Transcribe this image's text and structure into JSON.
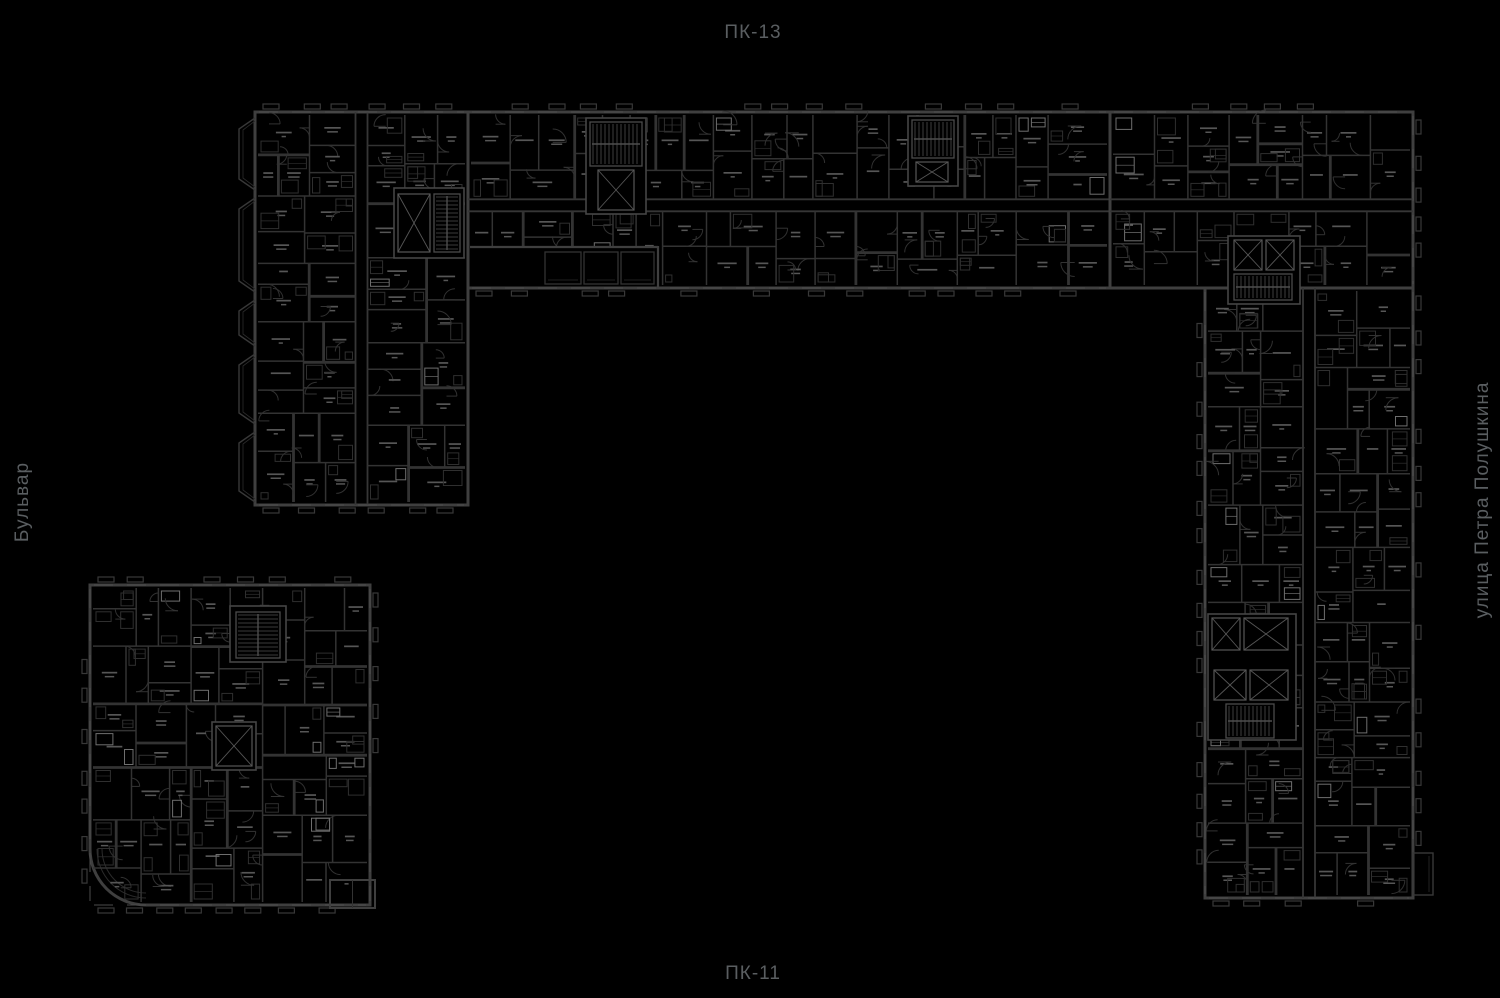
{
  "labels": {
    "top": "ПК-13",
    "bottom": "ПК-11",
    "left": "Бульвар",
    "right": "улица Петра Полушкина"
  },
  "colors": {
    "background": "#000000",
    "outer_wall": "#3f3f3f",
    "inner_wall": "#333333",
    "thin_line": "#2b2b2b",
    "fixture": "#2f2f2f",
    "fixture_bright": "#6e6e6e",
    "room_label_speck": "#565656",
    "door_arc": "#313131",
    "window": "#4c4c4c",
    "tick": "#383838",
    "core_line": "#565656",
    "stair_line": "#4e4e4e",
    "street_label": "#5a5e61"
  },
  "floorplan": {
    "canvas": {
      "width": 1500,
      "height": 998
    },
    "buildings": [
      {
        "id": "north-west-wing",
        "x": 255,
        "y": 112,
        "w": 213,
        "h": 393,
        "ticks": [
          "top",
          "bottom"
        ],
        "bays": "left",
        "corridor": "v",
        "seed": 101
      },
      {
        "id": "north-wing",
        "x": 468,
        "y": 112,
        "w": 642,
        "h": 176,
        "ticks": [
          "top",
          "bottom"
        ],
        "corridor": "h",
        "seed": 202
      },
      {
        "id": "north-east-block",
        "x": 1110,
        "y": 112,
        "w": 303,
        "h": 176,
        "ticks": [
          "top",
          "right"
        ],
        "corridor": "h",
        "seed": 303
      },
      {
        "id": "east-wing",
        "x": 1205,
        "y": 288,
        "w": 208,
        "h": 610,
        "ticks": [
          "left",
          "right",
          "bottom"
        ],
        "corridor": "v",
        "seed": 404
      },
      {
        "id": "south-west-building",
        "x": 90,
        "y": 585,
        "w": 280,
        "h": 320,
        "ticks": [
          "top",
          "left",
          "right",
          "bottom"
        ],
        "rounded_bl": 56,
        "seed": 505
      }
    ],
    "bays_left": [
      [
        118,
        190
      ],
      [
        198,
        292
      ],
      [
        300,
        346
      ],
      [
        354,
        424
      ],
      [
        432,
        502
      ]
    ],
    "notch": {
      "x": 470,
      "y": 246,
      "w": 188,
      "h": 40
    },
    "notch_balconies": [
      [
        545,
        252,
        36,
        32
      ],
      [
        584,
        252,
        34,
        32
      ],
      [
        621,
        252,
        33,
        32
      ]
    ],
    "annex": {
      "x": 330,
      "y": 880,
      "w": 45,
      "h": 28
    },
    "east_balcony": {
      "x": 1413,
      "y": 853,
      "w": 20,
      "h": 42
    },
    "cores": [
      {
        "black": [
          586,
          118,
          60,
          96
        ],
        "stair": [
          590,
          122,
          52,
          44
        ],
        "elev": [
          [
            598,
            170,
            36,
            40
          ]
        ]
      },
      {
        "black": [
          908,
          116,
          50,
          70
        ],
        "stair": [
          912,
          120,
          42,
          38
        ],
        "elev": [
          [
            916,
            162,
            32,
            20
          ]
        ]
      },
      {
        "black": [
          394,
          188,
          70,
          70
        ],
        "stair": [
          434,
          194,
          26,
          58
        ],
        "elev": [
          [
            398,
            194,
            32,
            58
          ]
        ]
      },
      {
        "black": [
          1228,
          236,
          72,
          68
        ],
        "stair": [
          1234,
          274,
          58,
          26
        ],
        "elev": [
          [
            1234,
            240,
            28,
            30
          ],
          [
            1266,
            240,
            28,
            30
          ]
        ]
      },
      {
        "black": [
          1208,
          614,
          88,
          126
        ],
        "stair": [
          1226,
          704,
          48,
          34
        ],
        "elev": [
          [
            1212,
            618,
            28,
            32
          ],
          [
            1244,
            618,
            44,
            32
          ],
          [
            1214,
            670,
            32,
            30
          ],
          [
            1250,
            670,
            38,
            30
          ]
        ]
      },
      {
        "black": [
          230,
          606,
          56,
          56
        ],
        "stair": [
          236,
          612,
          44,
          46
        ],
        "elev": []
      },
      {
        "black": [
          212,
          722,
          44,
          48
        ],
        "stair": null,
        "elev": [
          [
            216,
            726,
            36,
            40
          ]
        ]
      }
    ]
  }
}
